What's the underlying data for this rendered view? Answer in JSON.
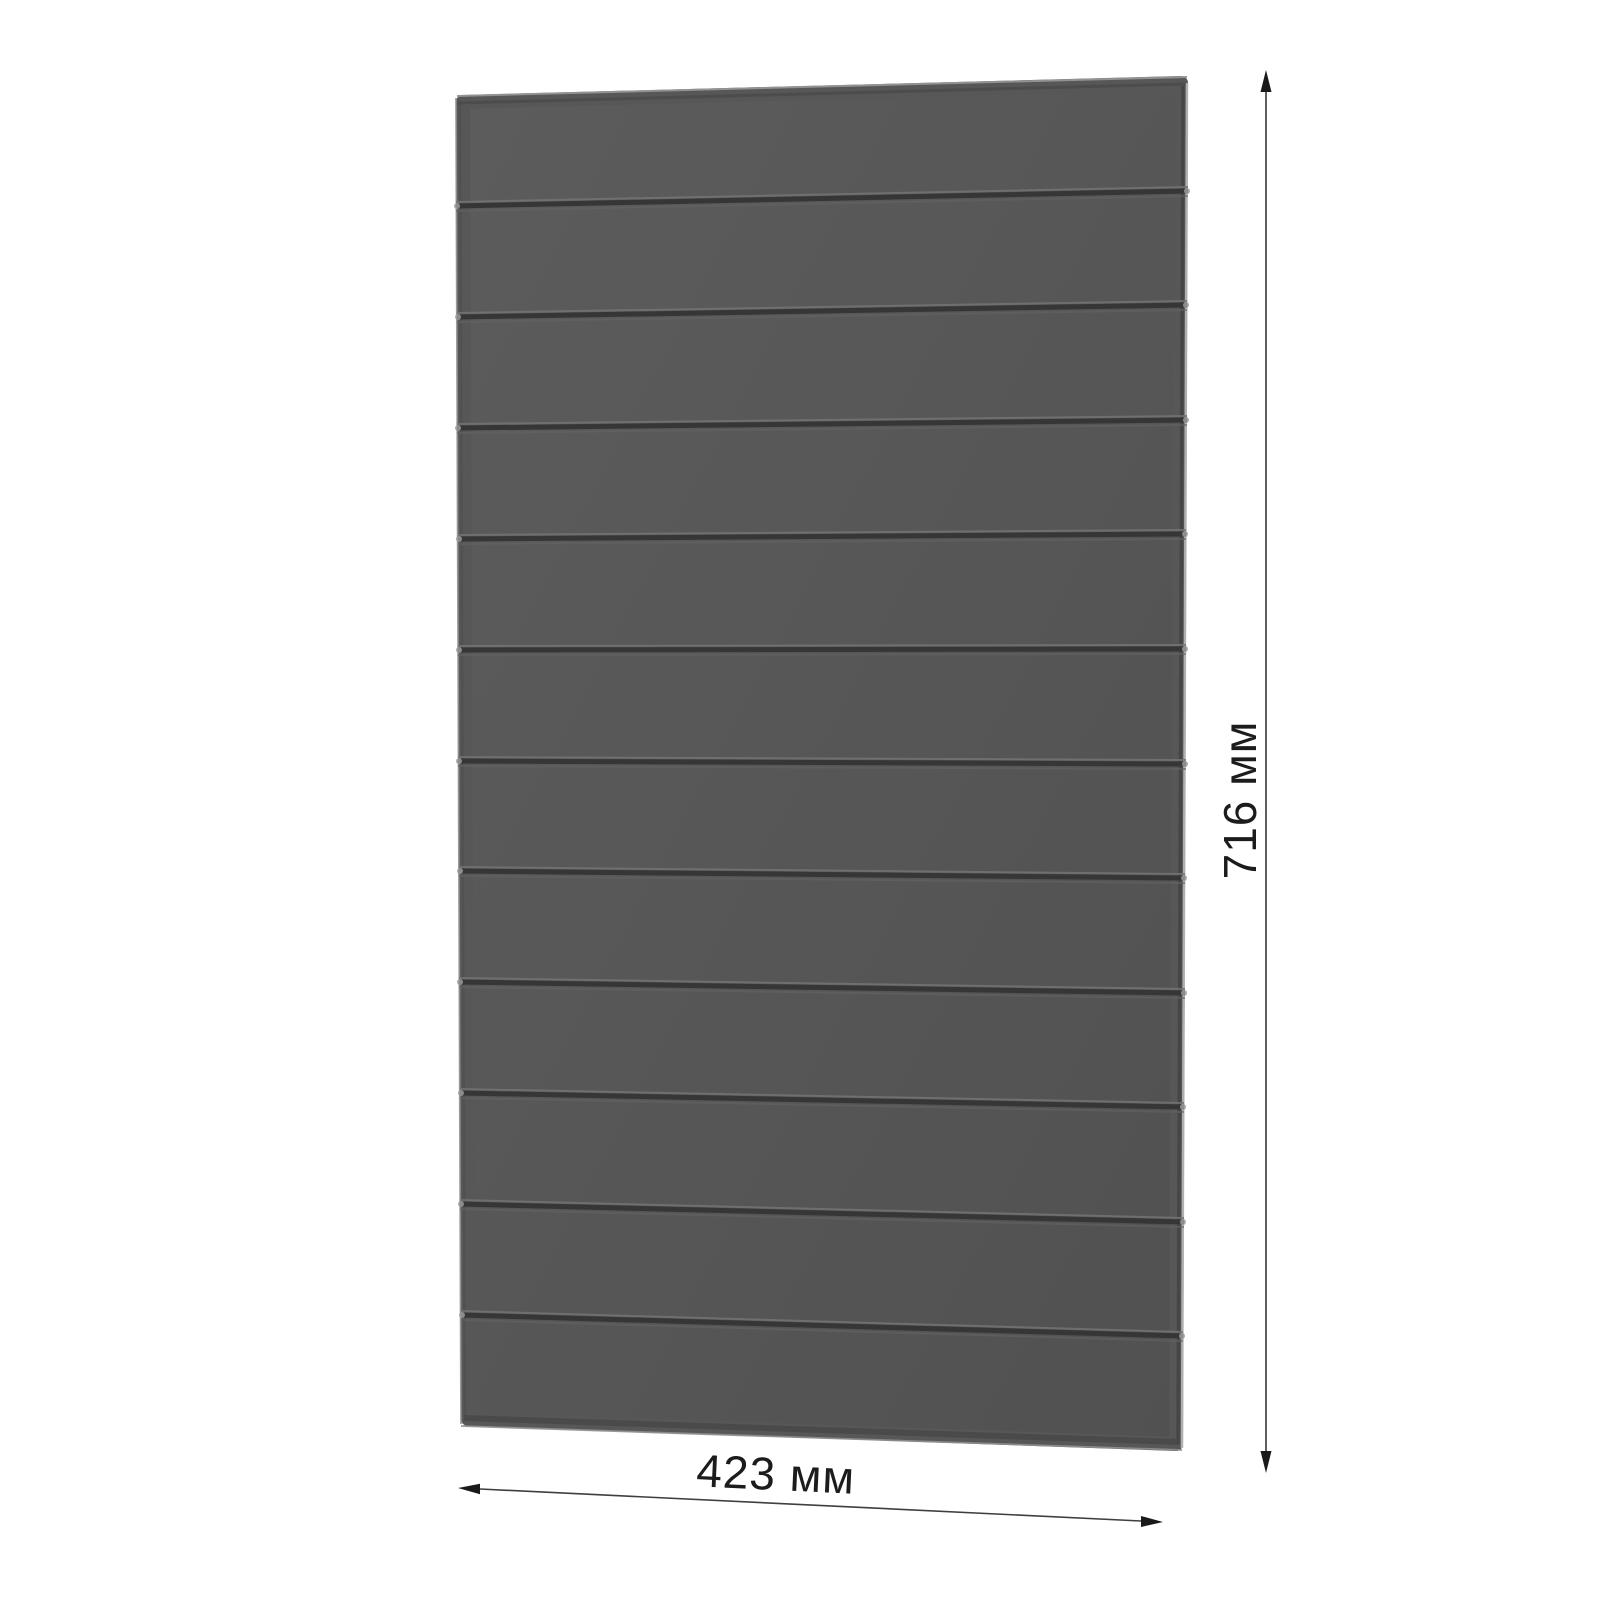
{
  "diagram": {
    "kind": "product-dimension-drawing",
    "object": "slatted wall panel, perspective view",
    "panel": {
      "slat_count": 12,
      "groove_count": 11
    },
    "dimensions": {
      "height_label": "716 мм",
      "width_label": "423 мм"
    },
    "colors": {
      "background": "#ffffff",
      "panel_face": "#575757",
      "panel_face_light": "#5d5d5d",
      "panel_face_dark": "#515151",
      "groove_shadow": "#363636",
      "groove_highlight": "#767676",
      "edge_light": "#b4b4b4",
      "edge_dark": "#434343",
      "dimension_line": "#5f5f5f",
      "arrow": "#1a1a1a",
      "label_text": "#1c1c1c"
    }
  }
}
